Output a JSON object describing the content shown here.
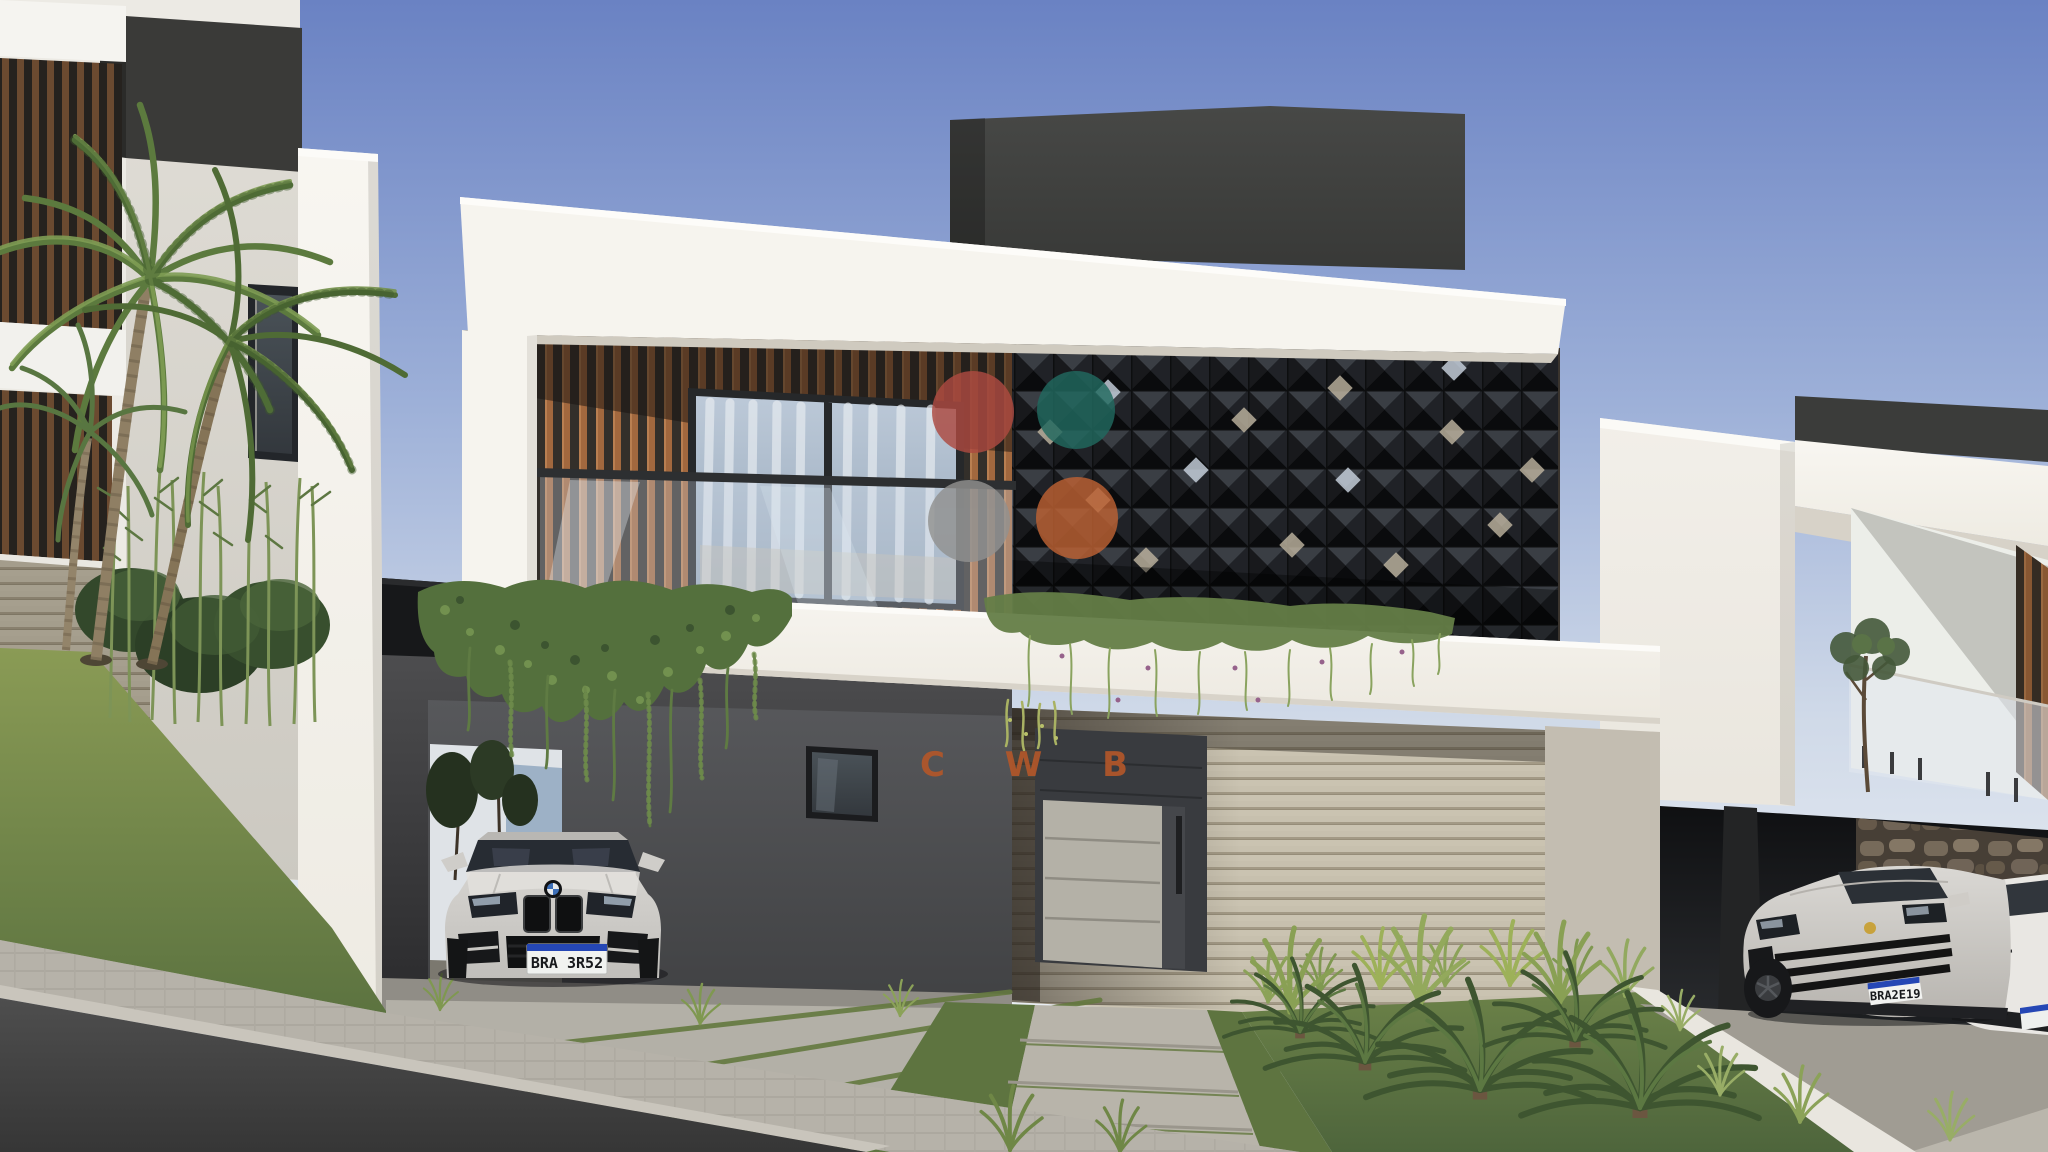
{
  "watermark": {
    "logo_letters": "C W B",
    "logo_color": "#b2572a",
    "circles": [
      {
        "id": "red-circle",
        "color": "#ad4a41"
      },
      {
        "id": "teal-circle",
        "color": "#21695f"
      },
      {
        "id": "gray-circle",
        "color": "#919190"
      },
      {
        "id": "orange-circle",
        "color": "#bd6133"
      }
    ]
  },
  "vehicles": {
    "bmw": {
      "plate_text": "BRA 3R52",
      "plate_band_color": "#2547b5"
    },
    "porsche": {
      "plate_text": "BRA2E19",
      "plate_band_color": "#2547b5"
    }
  },
  "palette": {
    "sky_top": "#6a82c3",
    "sky_mid": "#9db0d8",
    "sky_horizon": "#e9edf3",
    "facade_white": "#f6f4ee",
    "wood_slat": "#a2683e",
    "screen_dark": "#26282c",
    "concrete_board": "#c7c0ae",
    "door_panel": "#b4b1a7",
    "grass_green": "#6d8449",
    "street_asphalt": "#4e4e4e"
  }
}
